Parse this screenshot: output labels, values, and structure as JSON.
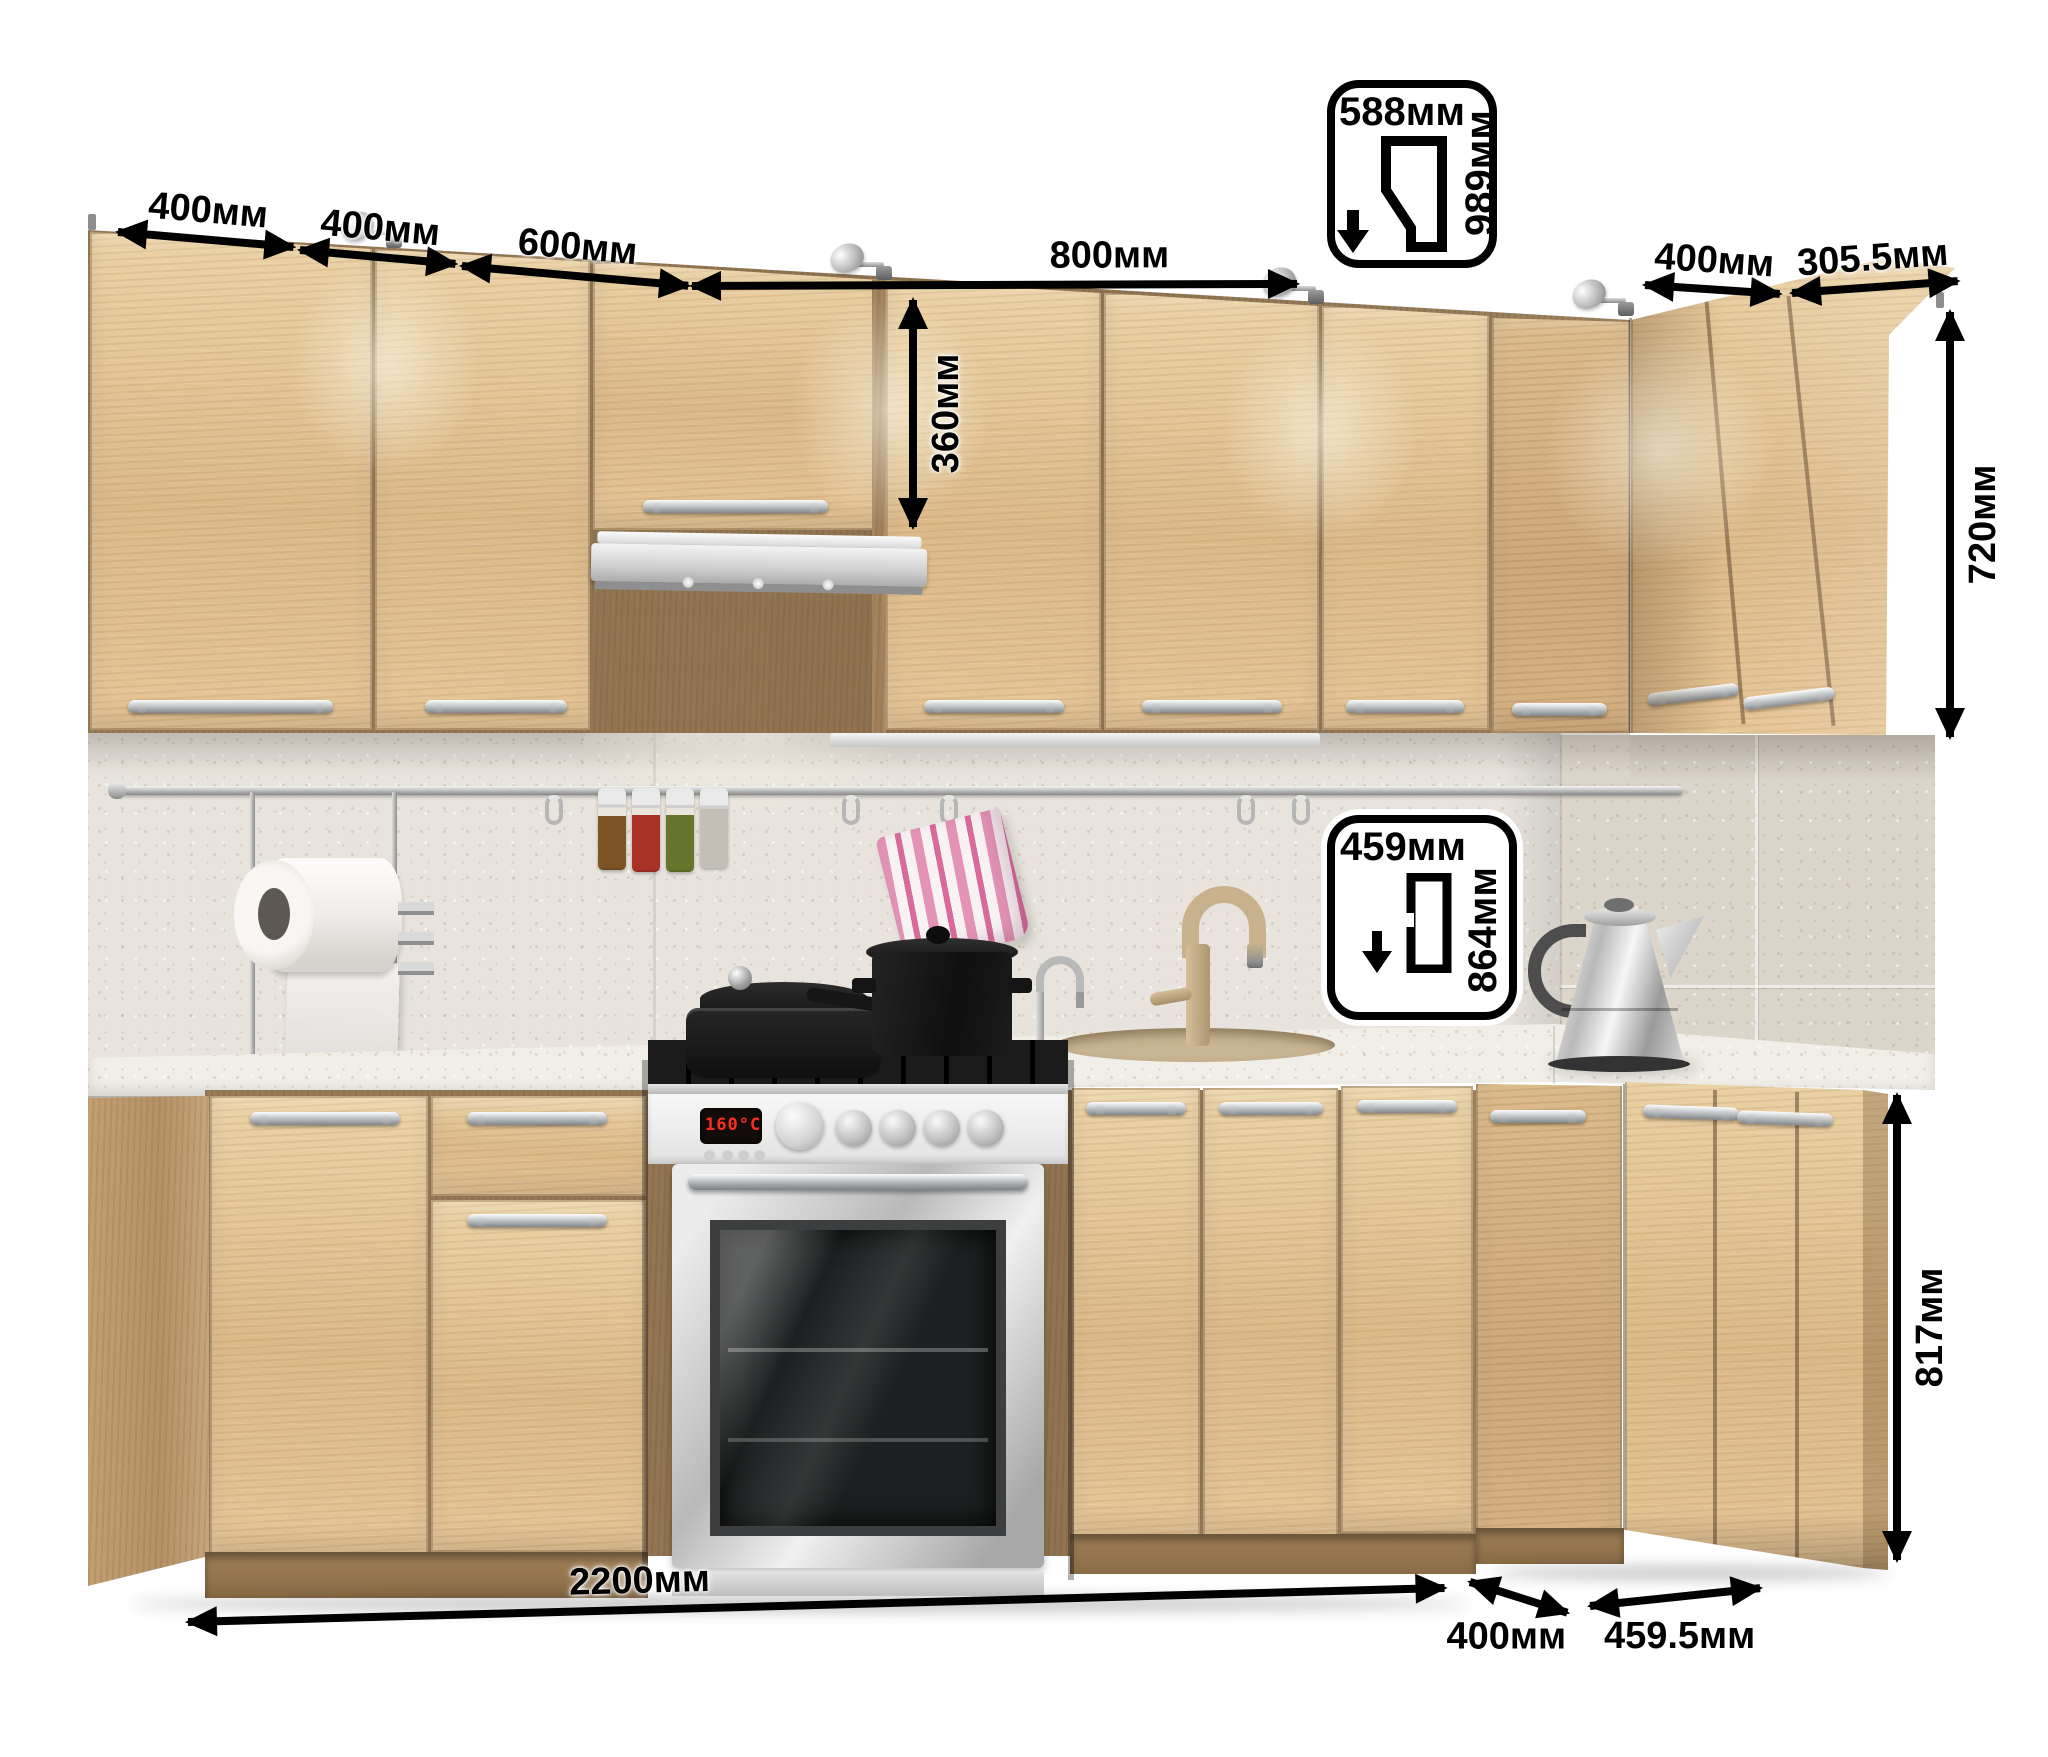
{
  "scene": {
    "description": "Corner kitchen set 3D render with dimension callouts",
    "unit": "мм"
  },
  "dimensions": {
    "top_row": [
      {
        "label": "400мм"
      },
      {
        "label": "400мм"
      },
      {
        "label": "600мм"
      },
      {
        "label": "800мм"
      }
    ],
    "right_top": [
      {
        "label": "400мм"
      },
      {
        "label": "305.5мм"
      }
    ],
    "hood_cabinet_height": "360мм",
    "wall_cabinet_height": "720мм",
    "base_cabinet_height": "817мм",
    "base_total_width": "2200мм",
    "base_corner_door_width": "400мм",
    "base_right_depth": "459.5мм"
  },
  "badges": {
    "wall_corner": {
      "width": "588мм",
      "height": "989мм"
    },
    "base_corner": {
      "width": "459мм",
      "height": "864мм"
    }
  },
  "appliances": {
    "stove_display": "160°C"
  },
  "colors": {
    "wood": "#dfbd8d",
    "counter": "#f1eee7",
    "backsplash": "#e8e4dd",
    "annotation": "#000000"
  }
}
